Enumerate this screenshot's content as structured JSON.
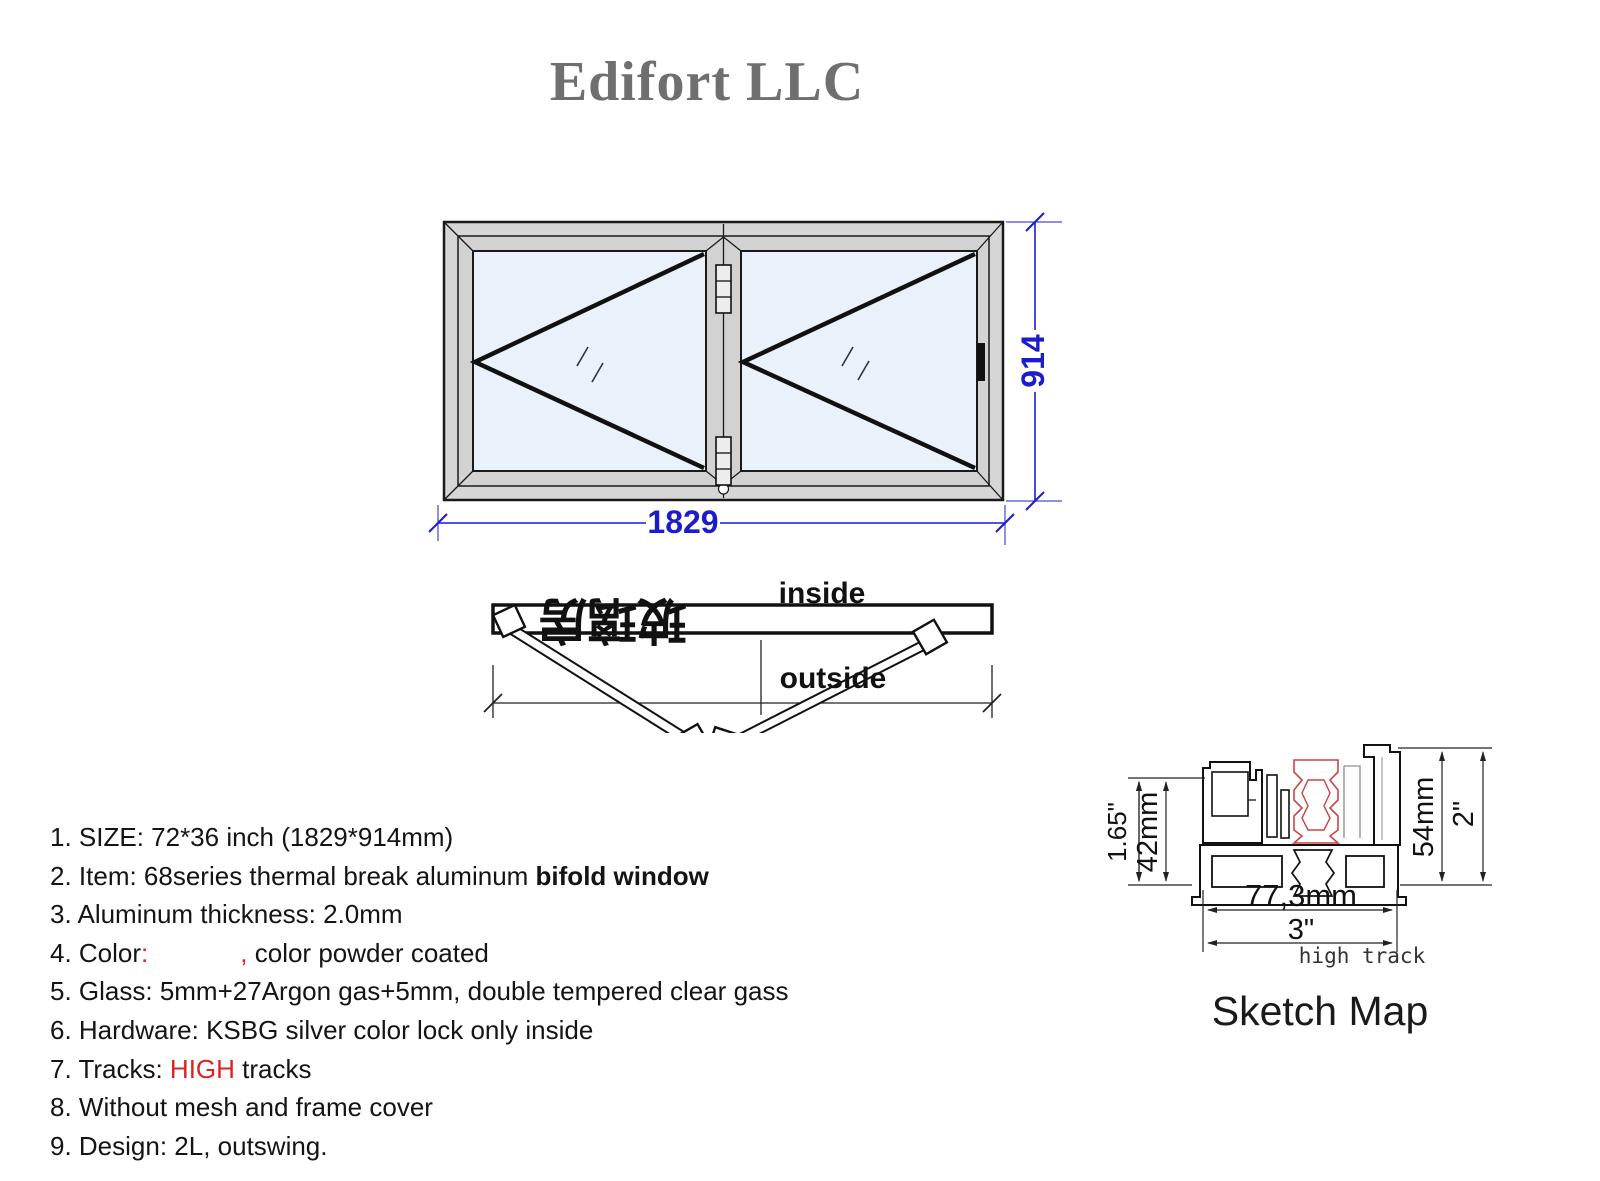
{
  "title": "Edifort LLC",
  "window": {
    "width_dim": "1829",
    "height_dim": "914"
  },
  "plan": {
    "inside_label": "inside",
    "outside_label": "outside",
    "watermark": "玻璃房"
  },
  "specs": {
    "line1": "1. SIZE: 72*36 inch (1829*914mm)",
    "line2_a": "2. Item: 68series thermal break aluminum ",
    "line2_b": "bifold window",
    "line3": "3. Aluminum thickness: 2.0mm",
    "line4_a": "4. Color",
    "line4_colon": ":",
    "line4_comma": ",",
    "line4_b": " color powder coated",
    "line5": "5. Glass: 5mm+27Argon gas+5mm, double tempered clear gass",
    "line6": "6. Hardware: KSBG silver color lock only inside",
    "line7_a": "7. Tracks: ",
    "line7_b": "HIGH",
    "line7_c": " tracks",
    "line8": "8. Without mesh and frame cover",
    "line9": "9. Design: 2L, outswing."
  },
  "sketch": {
    "dims": {
      "left_inch": "1.65\"",
      "left_mm": "42mm",
      "right_mm": "54mm",
      "right_inch": "2\"",
      "bottom_mm": "77,3mm",
      "bottom_inch": "3\""
    },
    "track_label": "high track",
    "caption": "Sketch Map"
  },
  "colors": {
    "dimension_blue": "#1c1ccc",
    "accent_red": "#dd2222",
    "title_gray": "#6f6f6f",
    "frame_gray": "#d6d6d6",
    "glass_blue": "#e9f2fa"
  }
}
